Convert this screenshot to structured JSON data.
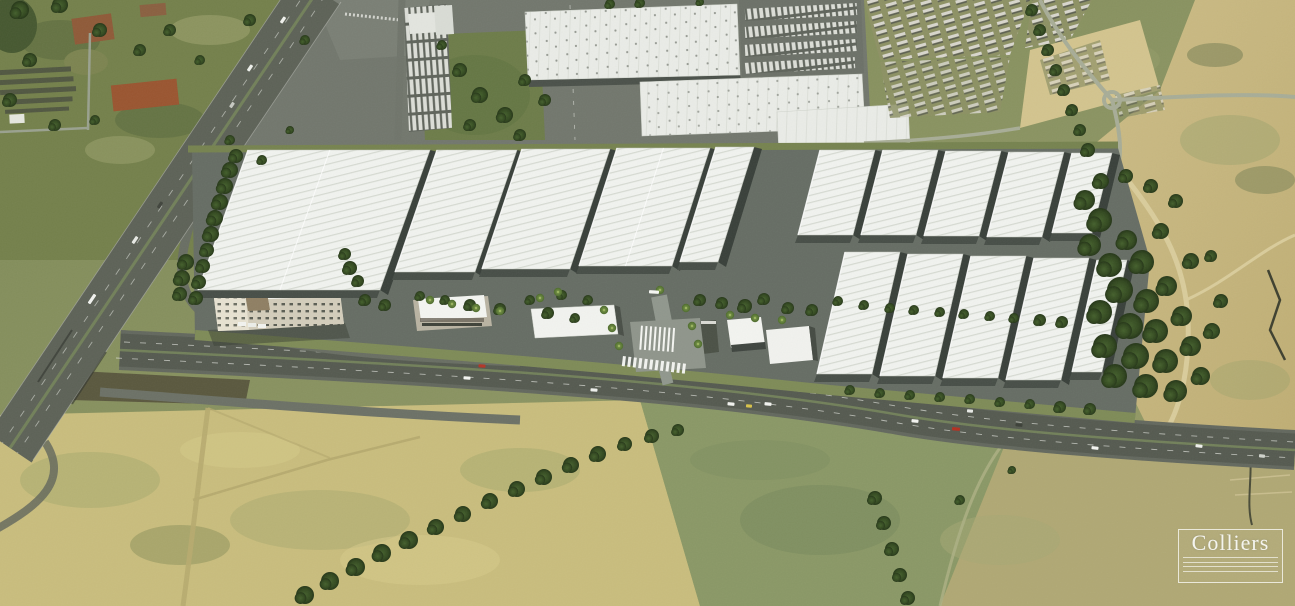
{
  "watermark": {
    "brand": "Colliers",
    "line_count": 4
  },
  "palette": {
    "field_olive": "#7d8753",
    "field_dark_green": "#5c7040",
    "field_yellow": "#c9bd7d",
    "sand": "#c7b77f",
    "asphalt": "#565b51",
    "apron_concrete": "#666d64",
    "roof_white": "#f0f2ee",
    "roof_rib": "#d6dad2",
    "dock_dark": "#39403a",
    "tree_green": "#33491f",
    "office_beige": "#ddd8c7",
    "red_soil": "#9a5530",
    "watermark_white": "rgba(255,255,255,0.85)"
  },
  "scene": {
    "back_row_buildings": [
      {
        "tx": 248,
        "ty": 150,
        "w": 182,
        "h": 140,
        "l": 50,
        "div": [
          0.45
        ]
      },
      {
        "tx": 437,
        "ty": 150,
        "w": 80,
        "h": 122,
        "l": 42
      },
      {
        "tx": 522,
        "ty": 149,
        "w": 88,
        "h": 120,
        "l": 40
      },
      {
        "tx": 617,
        "ty": 148,
        "w": 93,
        "h": 118,
        "l": 38,
        "div": [
          0.5
        ]
      },
      {
        "tx": 716,
        "ty": 147,
        "w": 38,
        "h": 115,
        "l": 36
      },
      {
        "tx": 820,
        "ty": 150,
        "w": 55,
        "h": 85,
        "l": 22
      },
      {
        "tx": 883,
        "ty": 150,
        "w": 55,
        "h": 85,
        "l": 22
      },
      {
        "tx": 946,
        "ty": 151,
        "w": 55,
        "h": 85,
        "l": 22
      },
      {
        "tx": 1009,
        "ty": 152,
        "w": 55,
        "h": 85,
        "l": 22
      },
      {
        "tx": 1072,
        "ty": 153,
        "w": 40,
        "h": 80,
        "l": 20
      }
    ],
    "front_row_buildings": [
      {
        "tx": 845,
        "ty": 252,
        "w": 55,
        "h": 122,
        "l": 28
      },
      {
        "tx": 908,
        "ty": 254,
        "w": 55,
        "h": 122,
        "l": 28
      },
      {
        "tx": 971,
        "ty": 256,
        "w": 55,
        "h": 122,
        "l": 28
      },
      {
        "tx": 1034,
        "ty": 258,
        "w": 55,
        "h": 122,
        "l": 28
      },
      {
        "tx": 1097,
        "ty": 260,
        "w": 30,
        "h": 112,
        "l": 25
      }
    ],
    "trees": [
      [
        196,
        298,
        7
      ],
      [
        199,
        282,
        7
      ],
      [
        203,
        266,
        7
      ],
      [
        207,
        250,
        7
      ],
      [
        211,
        234,
        8
      ],
      [
        215,
        218,
        8
      ],
      [
        220,
        202,
        8
      ],
      [
        225,
        186,
        8
      ],
      [
        230,
        170,
        8
      ],
      [
        236,
        156,
        7
      ],
      [
        186,
        262,
        8
      ],
      [
        182,
        278,
        8
      ],
      [
        180,
        294,
        7
      ],
      [
        350,
        268,
        7
      ],
      [
        358,
        281,
        6
      ],
      [
        345,
        254,
        6
      ],
      [
        365,
        300,
        6
      ],
      [
        385,
        305,
        6
      ],
      [
        420,
        296,
        5
      ],
      [
        445,
        300,
        5
      ],
      [
        470,
        305,
        6
      ],
      [
        500,
        309,
        6
      ],
      [
        530,
        300,
        5
      ],
      [
        548,
        313,
        6
      ],
      [
        562,
        295,
        5
      ],
      [
        575,
        318,
        5
      ],
      [
        588,
        300,
        5
      ],
      [
        700,
        300,
        6
      ],
      [
        722,
        303,
        6
      ],
      [
        745,
        306,
        7
      ],
      [
        764,
        299,
        6
      ],
      [
        788,
        308,
        6
      ],
      [
        812,
        310,
        6
      ],
      [
        838,
        301,
        5
      ],
      [
        864,
        305,
        5
      ],
      [
        890,
        308,
        5
      ],
      [
        914,
        310,
        5
      ],
      [
        940,
        312,
        5
      ],
      [
        964,
        314,
        5
      ],
      [
        990,
        316,
        5
      ],
      [
        1014,
        318,
        5
      ],
      [
        1040,
        320,
        6
      ],
      [
        1062,
        322,
        6
      ],
      [
        1085,
        200,
        10
      ],
      [
        1100,
        220,
        12
      ],
      [
        1090,
        245,
        11
      ],
      [
        1110,
        265,
        12
      ],
      [
        1127,
        240,
        10
      ],
      [
        1142,
        262,
        12
      ],
      [
        1120,
        290,
        13
      ],
      [
        1147,
        301,
        12
      ],
      [
        1167,
        286,
        10
      ],
      [
        1100,
        312,
        12
      ],
      [
        1130,
        326,
        13
      ],
      [
        1156,
        331,
        12
      ],
      [
        1182,
        316,
        10
      ],
      [
        1105,
        346,
        12
      ],
      [
        1136,
        356,
        13
      ],
      [
        1166,
        361,
        12
      ],
      [
        1191,
        346,
        10
      ],
      [
        1115,
        376,
        12
      ],
      [
        1146,
        386,
        12
      ],
      [
        1176,
        391,
        11
      ],
      [
        1201,
        376,
        9
      ],
      [
        1212,
        331,
        8
      ],
      [
        1221,
        301,
        7
      ],
      [
        1191,
        261,
        8
      ],
      [
        1161,
        231,
        8
      ],
      [
        1176,
        201,
        7
      ],
      [
        1151,
        186,
        7
      ],
      [
        1126,
        176,
        7
      ],
      [
        1101,
        181,
        8
      ],
      [
        1211,
        256,
        6
      ],
      [
        850,
        390,
        5
      ],
      [
        880,
        393,
        5
      ],
      [
        910,
        395,
        5
      ],
      [
        940,
        397,
        5
      ],
      [
        970,
        399,
        5
      ],
      [
        1000,
        402,
        5
      ],
      [
        1030,
        404,
        5
      ],
      [
        1060,
        407,
        6
      ],
      [
        1090,
        409,
        6
      ],
      [
        20,
        10,
        9
      ],
      [
        60,
        5,
        8
      ],
      [
        100,
        30,
        7
      ],
      [
        140,
        50,
        6
      ],
      [
        30,
        60,
        7
      ],
      [
        10,
        100,
        7
      ],
      [
        55,
        125,
        6
      ],
      [
        95,
        120,
        5
      ],
      [
        170,
        30,
        6
      ],
      [
        200,
        60,
        5
      ],
      [
        250,
        20,
        6
      ],
      [
        305,
        40,
        5
      ],
      [
        230,
        140,
        5
      ],
      [
        262,
        160,
        5
      ],
      [
        290,
        130,
        4
      ],
      [
        460,
        70,
        7
      ],
      [
        480,
        95,
        8
      ],
      [
        505,
        115,
        8
      ],
      [
        525,
        80,
        6
      ],
      [
        545,
        100,
        6
      ],
      [
        470,
        125,
        6
      ],
      [
        442,
        45,
        5
      ],
      [
        520,
        135,
        6
      ],
      [
        305,
        595,
        9
      ],
      [
        330,
        581,
        9
      ],
      [
        356,
        567,
        9
      ],
      [
        382,
        553,
        9
      ],
      [
        409,
        540,
        9
      ],
      [
        436,
        527,
        8
      ],
      [
        463,
        514,
        8
      ],
      [
        490,
        501,
        8
      ],
      [
        517,
        489,
        8
      ],
      [
        544,
        477,
        8
      ],
      [
        571,
        465,
        8
      ],
      [
        598,
        454,
        8
      ],
      [
        625,
        444,
        7
      ],
      [
        652,
        436,
        7
      ],
      [
        678,
        430,
        6
      ],
      [
        875,
        498,
        7
      ],
      [
        884,
        523,
        7
      ],
      [
        892,
        549,
        7
      ],
      [
        900,
        575,
        7
      ],
      [
        908,
        598,
        7
      ],
      [
        960,
        500,
        5
      ],
      [
        1012,
        470,
        4
      ],
      [
        610,
        4,
        5
      ],
      [
        640,
        3,
        5
      ],
      [
        700,
        2,
        4
      ],
      [
        1032,
        10,
        6
      ],
      [
        1040,
        30,
        6
      ],
      [
        1048,
        50,
        6
      ],
      [
        1056,
        70,
        6
      ],
      [
        1064,
        90,
        6
      ],
      [
        1072,
        110,
        6
      ],
      [
        1080,
        130,
        6
      ],
      [
        1088,
        150,
        7
      ]
    ],
    "palms": [
      [
        540,
        298
      ],
      [
        558,
        292
      ],
      [
        604,
        310
      ],
      [
        612,
        328
      ],
      [
        619,
        346
      ],
      [
        686,
        308
      ],
      [
        692,
        326
      ],
      [
        698,
        344
      ],
      [
        730,
        315
      ],
      [
        755,
        318
      ],
      [
        782,
        320
      ],
      [
        430,
        300
      ],
      [
        452,
        304
      ],
      [
        476,
        308
      ],
      [
        500,
        311
      ],
      [
        660,
        290
      ]
    ],
    "cars": [
      [
        467,
        378,
        4,
        "#f5f6f2",
        7
      ],
      [
        482,
        366,
        4,
        "#b33526",
        7
      ],
      [
        594,
        390,
        4,
        "#eef0ec",
        7
      ],
      [
        731,
        404,
        5,
        "#f2f3ef",
        7
      ],
      [
        749,
        406,
        5,
        "#d9c34a",
        6
      ],
      [
        768,
        404,
        5,
        "#f2f3ef",
        7
      ],
      [
        915,
        421,
        5,
        "#f4f5f1",
        7
      ],
      [
        956,
        429,
        5,
        "#b23020",
        8
      ],
      [
        1019,
        425,
        5,
        "#3c4038",
        7
      ],
      [
        1095,
        448,
        6,
        "#f4f5f1",
        7
      ],
      [
        970,
        411,
        5,
        "#e8eae6",
        6
      ],
      [
        1199,
        446,
        6,
        "#f0f1ed",
        7
      ],
      [
        1262,
        456,
        6,
        "#cfd2cb",
        6
      ],
      [
        92,
        299,
        -56,
        "#f2f3ef",
        11
      ],
      [
        135,
        240,
        -56,
        "#e8eae5",
        8
      ],
      [
        160,
        205,
        -56,
        "#40443c",
        7
      ],
      [
        250,
        68,
        -56,
        "#eef0eb",
        7
      ],
      [
        232,
        105,
        -56,
        "#c7c9c2",
        6
      ],
      [
        283,
        20,
        -56,
        "#f0f1ec",
        7
      ],
      [
        654,
        292,
        3,
        "#f6f7f3",
        10
      ]
    ]
  }
}
